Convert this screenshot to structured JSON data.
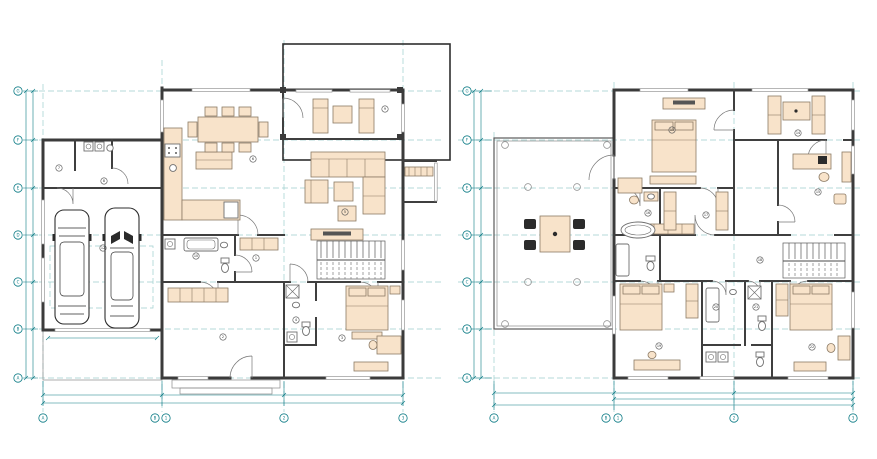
{
  "colors": {
    "background": "#ffffff",
    "wall": "#3b3b3b",
    "furniture_fill": "#f8e3ca",
    "furniture_stroke": "#8c7a64",
    "fixture_fill": "#ffffff",
    "dimension_teal": "#0e7c86",
    "grid_dashed_teal": "#9ccecd",
    "car_outline": "#2e2e2e",
    "dark_chair": "#2b2b2b"
  },
  "plans": {
    "ground_floor": {
      "col_bubbles": [
        {
          "x": 43,
          "y": 418,
          "label": "A"
        },
        {
          "x": 155,
          "y": 418,
          "label": "B"
        },
        {
          "x": 166,
          "y": 418,
          "label": "1"
        },
        {
          "x": 284,
          "y": 418,
          "label": "2"
        },
        {
          "x": 403,
          "y": 418,
          "label": "3"
        }
      ],
      "row_bubbles": [
        {
          "x": 18,
          "y": 91,
          "label": "G"
        },
        {
          "x": 18,
          "y": 140,
          "label": "F"
        },
        {
          "x": 18,
          "y": 188,
          "label": "E"
        },
        {
          "x": 18,
          "y": 235,
          "label": "D"
        },
        {
          "x": 18,
          "y": 282,
          "label": "C"
        },
        {
          "x": 18,
          "y": 329,
          "label": "B"
        },
        {
          "x": 18,
          "y": 378,
          "label": "A"
        }
      ],
      "dim_labels": [
        {
          "x": 102,
          "y": 393.4,
          "label": "6 055"
        },
        {
          "x": 223,
          "y": 393.4,
          "label": "6 360"
        },
        {
          "x": 343,
          "y": 393.4,
          "label": "6 160"
        },
        {
          "x": 223,
          "y": 401.4,
          "label": "18 475"
        },
        {
          "x": 31.4,
          "y": 116,
          "r": -90,
          "label": "2 655"
        },
        {
          "x": 31.4,
          "y": 164,
          "r": -90,
          "label": "2 655"
        },
        {
          "x": 31.4,
          "y": 212,
          "r": -90,
          "label": "2 655"
        },
        {
          "x": 31.4,
          "y": 259,
          "r": -90,
          "label": "2 655"
        },
        {
          "x": 31.4,
          "y": 306,
          "r": -90,
          "label": "2 655"
        },
        {
          "x": 31.4,
          "y": 354,
          "r": -90,
          "label": "2 655"
        },
        {
          "x": 24.4,
          "y": 235,
          "r": -90,
          "label": "15 930"
        },
        {
          "x": 102,
          "y": 335.4,
          "label": "5 775"
        },
        {
          "x": 228,
          "y": 104,
          "label": "2 880"
        },
        {
          "x": 348,
          "y": 150,
          "label": "3 155"
        },
        {
          "x": 222,
          "y": 177,
          "label": "1 485"
        },
        {
          "x": 212,
          "y": 224,
          "label": "2 400"
        },
        {
          "x": 337,
          "y": 226,
          "label": "1 800"
        },
        {
          "x": 207,
          "y": 291,
          "label": "2 100"
        },
        {
          "x": 300,
          "y": 353,
          "label": "900"
        },
        {
          "x": 367,
          "y": 335,
          "label": "1 600"
        },
        {
          "x": 97,
          "y": 193,
          "label": "750"
        },
        {
          "x": 390,
          "y": 253,
          "r": -90,
          "label": "1 200"
        }
      ],
      "room_markers": [
        {
          "x": 59,
          "y": 168,
          "label": "7"
        },
        {
          "x": 104,
          "y": 181,
          "label": "8"
        },
        {
          "x": 103,
          "y": 248,
          "label": "12"
        },
        {
          "x": 253,
          "y": 159,
          "label": "6"
        },
        {
          "x": 345,
          "y": 212,
          "label": "5"
        },
        {
          "x": 385,
          "y": 109,
          "label": "9"
        },
        {
          "x": 223,
          "y": 337,
          "label": "2"
        },
        {
          "x": 342,
          "y": 338,
          "label": "3"
        },
        {
          "x": 296,
          "y": 320,
          "label": "4"
        },
        {
          "x": 256,
          "y": 258,
          "label": "1"
        },
        {
          "x": 196,
          "y": 256,
          "label": "10"
        }
      ]
    },
    "first_floor": {
      "col_bubbles": [
        {
          "x": 494,
          "y": 418,
          "label": "A"
        },
        {
          "x": 606,
          "y": 418,
          "label": "B"
        },
        {
          "x": 618,
          "y": 418,
          "label": "1"
        },
        {
          "x": 734,
          "y": 418,
          "label": "2"
        },
        {
          "x": 853,
          "y": 418,
          "label": "3"
        }
      ],
      "row_bubbles": [
        {
          "x": 467,
          "y": 91,
          "label": "G"
        },
        {
          "x": 467,
          "y": 140,
          "label": "F"
        },
        {
          "x": 467,
          "y": 188,
          "label": "E"
        },
        {
          "x": 467,
          "y": 235,
          "label": "D"
        },
        {
          "x": 467,
          "y": 282,
          "label": "C"
        },
        {
          "x": 467,
          "y": 329,
          "label": "B"
        },
        {
          "x": 467,
          "y": 378,
          "label": "A"
        }
      ],
      "dim_labels": [
        {
          "x": 554,
          "y": 391.4,
          "label": "6 275"
        },
        {
          "x": 674,
          "y": 391.4,
          "label": "6 280"
        },
        {
          "x": 794,
          "y": 391.4,
          "label": "6 240"
        },
        {
          "x": 734,
          "y": 397.4,
          "label": "12 520"
        },
        {
          "x": 674,
          "y": 403.4,
          "label": "18 475"
        },
        {
          "x": 479.4,
          "y": 116,
          "r": -90,
          "label": "2 655"
        },
        {
          "x": 479.4,
          "y": 164,
          "r": -90,
          "label": "2 655"
        },
        {
          "x": 479.4,
          "y": 212,
          "r": -90,
          "label": "2 655"
        },
        {
          "x": 479.4,
          "y": 259,
          "r": -90,
          "label": "2 655"
        },
        {
          "x": 479.4,
          "y": 306,
          "r": -90,
          "label": "2 655"
        },
        {
          "x": 479.4,
          "y": 354,
          "r": -90,
          "label": "2 655"
        },
        {
          "x": 472.4,
          "y": 235,
          "r": -90,
          "label": "15 930"
        },
        {
          "x": 700,
          "y": 96,
          "label": "1 930"
        },
        {
          "x": 672,
          "y": 117,
          "label": "2 100"
        },
        {
          "x": 800,
          "y": 124,
          "label": "1 600"
        },
        {
          "x": 812,
          "y": 151,
          "label": "1 400"
        },
        {
          "x": 640,
          "y": 218,
          "label": "2 400"
        },
        {
          "x": 641,
          "y": 336,
          "label": "1 800"
        },
        {
          "x": 714,
          "y": 352,
          "label": "1 200"
        },
        {
          "x": 810,
          "y": 334,
          "label": "2 000"
        },
        {
          "x": 822,
          "y": 358,
          "label": "900"
        },
        {
          "x": 555,
          "y": 260,
          "label": "1 500"
        },
        {
          "x": 736,
          "y": 292,
          "label": "750"
        }
      ],
      "room_markers": [
        {
          "x": 672,
          "y": 130,
          "label": "13"
        },
        {
          "x": 798,
          "y": 133,
          "label": "14"
        },
        {
          "x": 818,
          "y": 192,
          "label": "15"
        },
        {
          "x": 648,
          "y": 213,
          "label": "16"
        },
        {
          "x": 706,
          "y": 215,
          "label": "17"
        },
        {
          "x": 760,
          "y": 260,
          "label": "18"
        },
        {
          "x": 659,
          "y": 346,
          "label": "19"
        },
        {
          "x": 716,
          "y": 307,
          "label": "20"
        },
        {
          "x": 756,
          "y": 307,
          "label": "21"
        },
        {
          "x": 812,
          "y": 347,
          "label": "22"
        }
      ]
    }
  }
}
